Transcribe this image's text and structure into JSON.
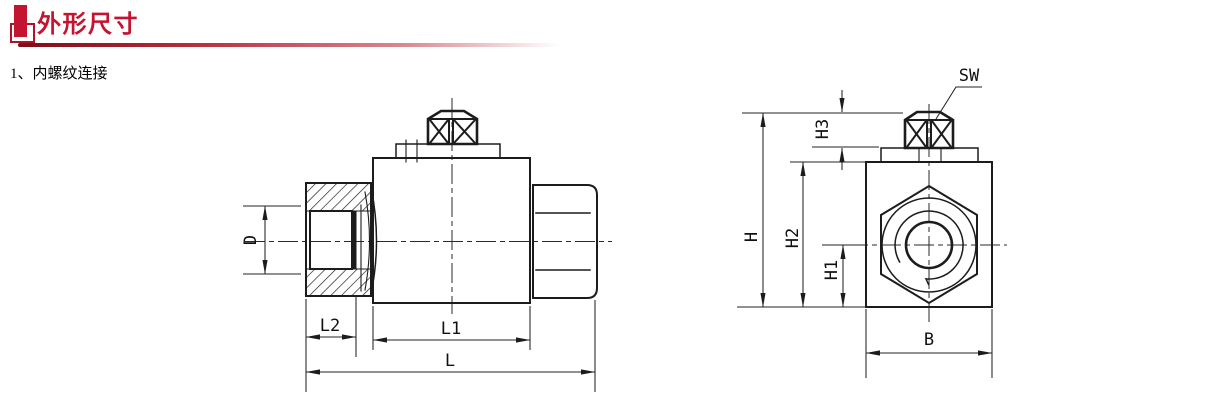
{
  "page": {
    "title": "外形尺寸",
    "section_label": "1、内螺纹连接"
  },
  "colors": {
    "accent_red": "#c41430",
    "drawing_line": "#1c1c1c"
  },
  "side_view": {
    "labels": {
      "d": "D",
      "l2": "L2",
      "l1": "L1",
      "l": "L"
    }
  },
  "front_view": {
    "labels": {
      "sw": "SW",
      "h3": "H3",
      "h": "H",
      "h2": "H2",
      "h1": "H1",
      "b": "B"
    }
  }
}
